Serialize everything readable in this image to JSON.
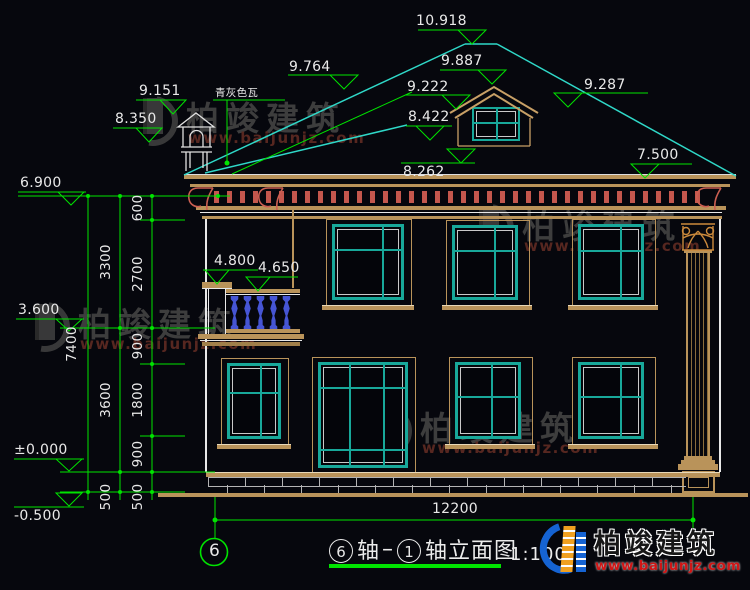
{
  "title_block": {
    "axis_from": "6",
    "axis_word": "轴",
    "dash": "–",
    "axis_to": "1",
    "suffix": "轴立面图",
    "scale": "1:100"
  },
  "axis_bubble": "6",
  "notes": {
    "roof_material": "青灰色瓦"
  },
  "levels": {
    "ridge": "10.918",
    "dormer_apex": "9.887",
    "roof_left": "9.764",
    "dormer_eave": "9.222",
    "roof_right": "9.287",
    "dormer_sill": "8.422",
    "eave": "8.262",
    "eave_right": "7.500",
    "chimney_top": "9.151",
    "chimney_base": "8.350",
    "balcony_cap": "4.800",
    "balcony_rail": "4.650",
    "parapet": "6.900",
    "floor2": "3.600",
    "ground": "±0.000",
    "site": "-0.500"
  },
  "dimensions": {
    "total_height": "7400",
    "chain_mid": [
      "3300",
      "3600",
      "500"
    ],
    "chain_inner": [
      "600",
      "2700",
      "900",
      "1800",
      "900",
      "500"
    ],
    "width": "12200"
  },
  "watermark": {
    "name": "柏竣建筑",
    "url": "www.baijunjz.com"
  },
  "brand": {
    "name": "柏竣建筑",
    "url": "www.baijunjz.com"
  },
  "colors": {
    "dim_green": "#00e400",
    "roof_cyan": "#2fd8c8",
    "window_teal": "#18a89a",
    "trim_tan": "#b9935a",
    "accent_red": "#cc5f52",
    "baluster_blue": "#4655d4",
    "brand_blue": "#1563d2",
    "brand_orange": "#f0a020",
    "url_red": "#d01515"
  }
}
